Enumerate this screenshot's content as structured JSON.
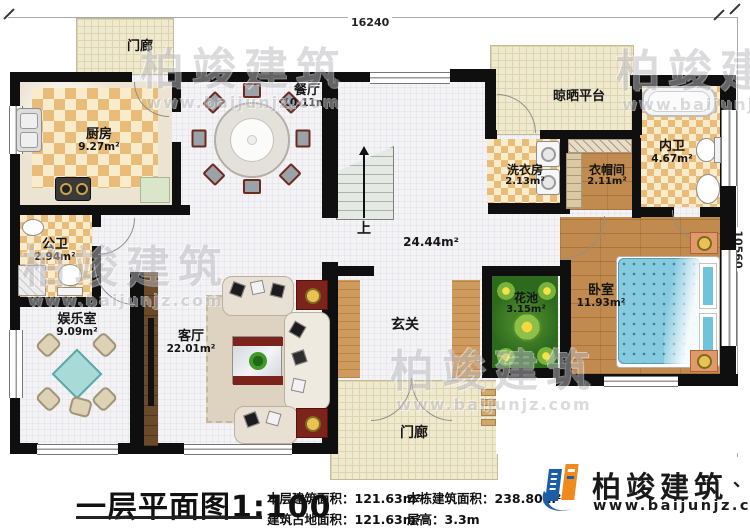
{
  "dimensions": {
    "top": "16240",
    "right": "10560"
  },
  "watermark": {
    "text": "柏竣建筑",
    "url": "www.baijunjz.com"
  },
  "rooms": {
    "porch_top": {
      "name": "门廊"
    },
    "kitchen": {
      "name": "厨房",
      "area": "9.27m²"
    },
    "dining": {
      "name": "餐厅",
      "area": "10.11m²"
    },
    "drying_platform": {
      "name": "晾晒平台"
    },
    "laundry": {
      "name": "洗衣房",
      "area": "2.13m²"
    },
    "cloakroom": {
      "name": "衣帽间",
      "area": "2.11m²"
    },
    "master_bath": {
      "name": "内卫",
      "area": "4.67m²"
    },
    "public_bath": {
      "name": "公卫",
      "area": "2.94m²"
    },
    "entertainment": {
      "name": "娱乐室",
      "area": "9.09m²"
    },
    "living": {
      "name": "客厅",
      "area": "22.01m²"
    },
    "hall": {
      "area": "24.44m²"
    },
    "stairs": {
      "label": "上"
    },
    "foyer": {
      "name": "玄关"
    },
    "flower_bed": {
      "name": "花池",
      "area": "3.15m²"
    },
    "bedroom": {
      "name": "卧室",
      "area": "11.93m²"
    },
    "porch_bottom": {
      "name": "门廊"
    }
  },
  "footer": {
    "title": "一层平面图1:100",
    "stats": [
      {
        "label": "本层建筑面积：",
        "value": "121.63m²"
      },
      {
        "label": "本栋建筑面积：",
        "value": "238.80m²"
      },
      {
        "label": "建筑占地面积：",
        "value": "121.63m²"
      },
      {
        "label": "层高：",
        "value": "3.3m"
      }
    ]
  },
  "logo": {
    "name": "柏竣建筑",
    "url": "www.baijunjz.com",
    "tick": "、"
  }
}
